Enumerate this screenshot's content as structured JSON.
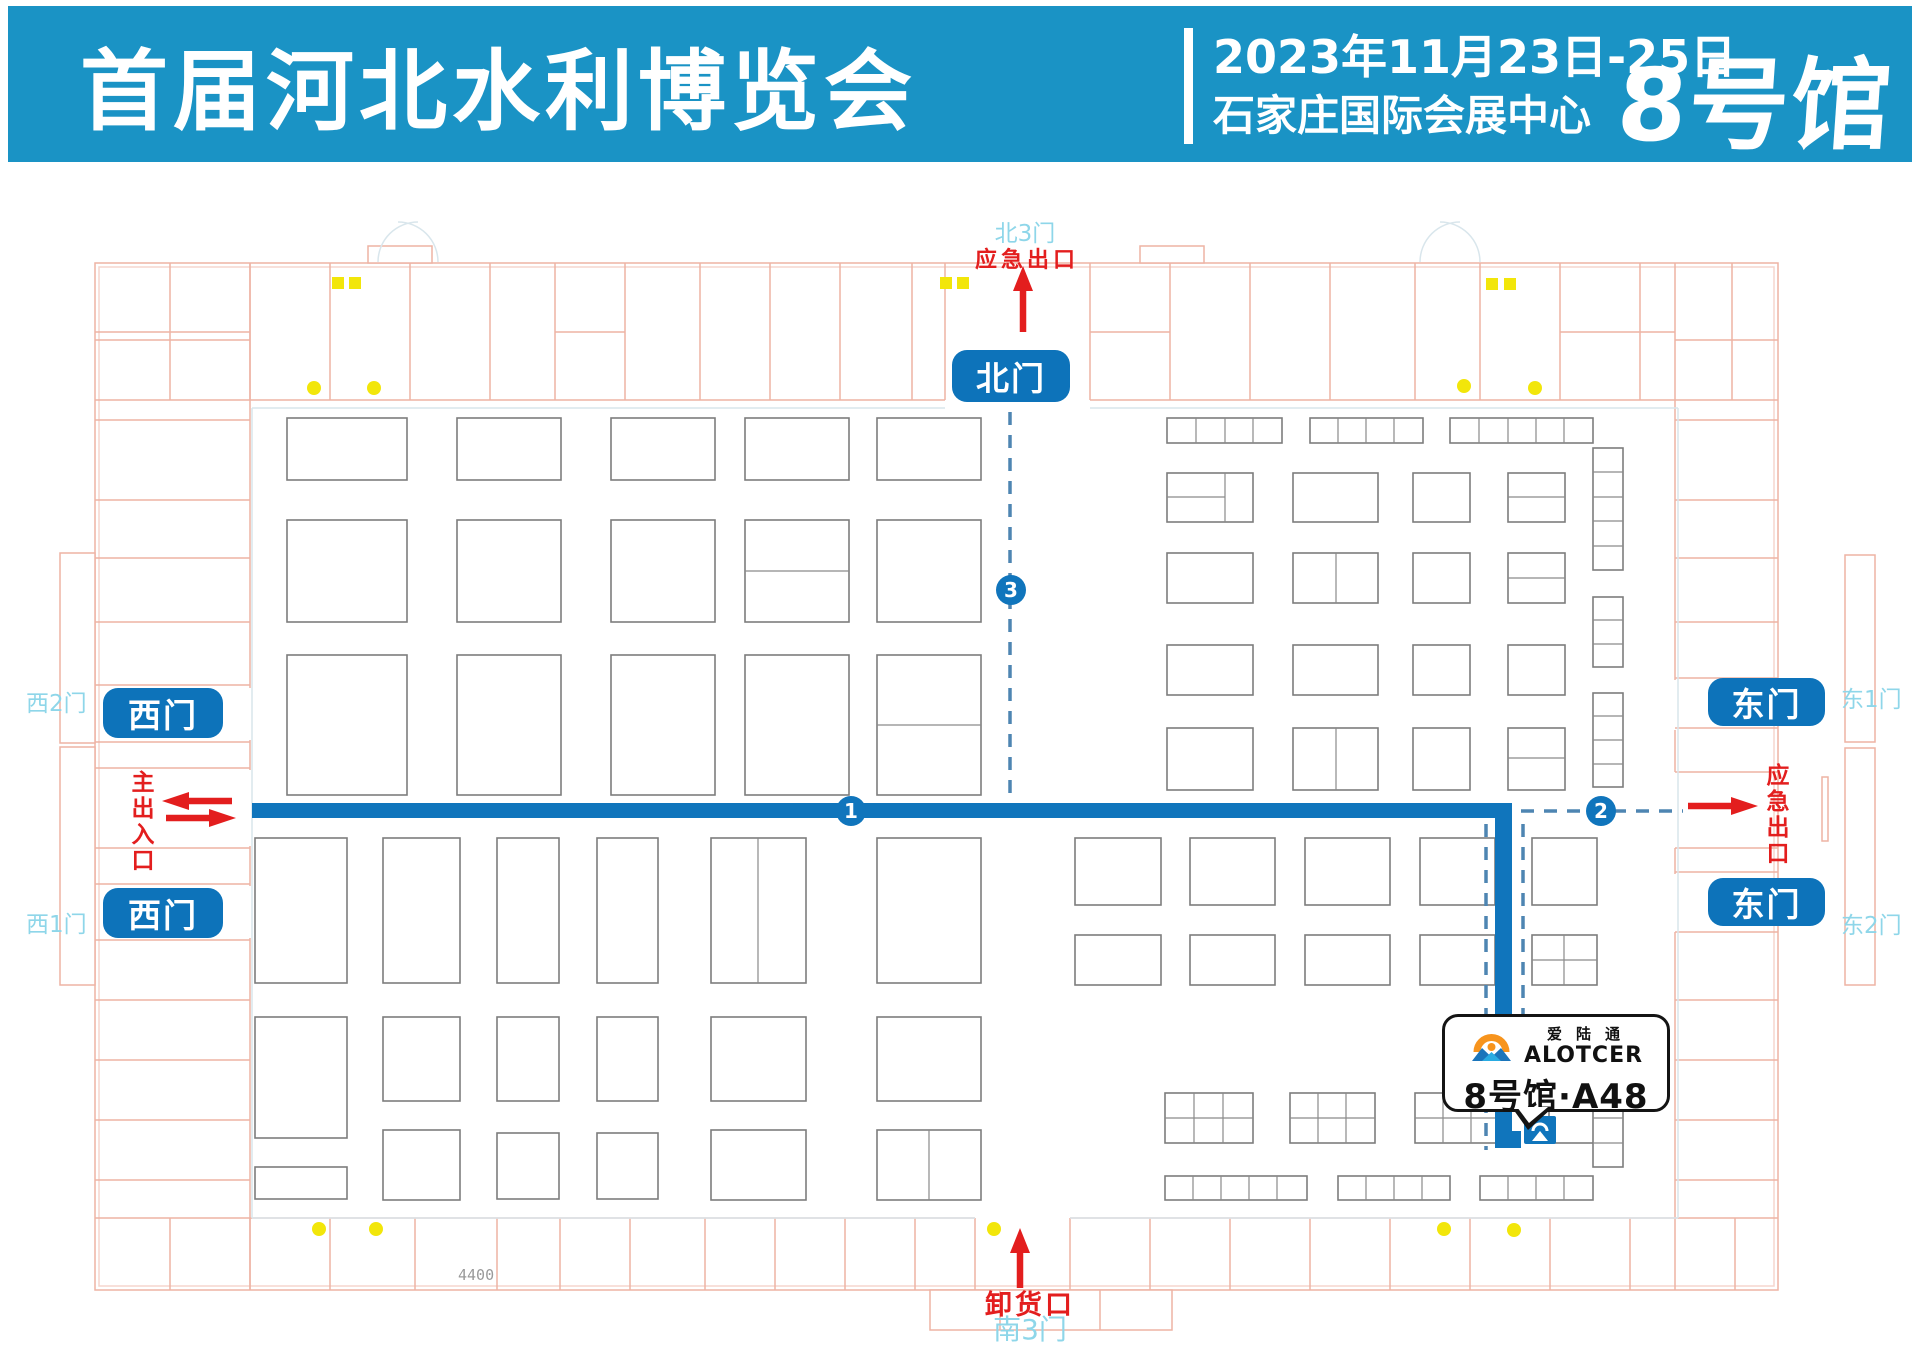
{
  "header": {
    "title": "首届河北水利博览会",
    "date": "2023年11月23日-25日",
    "venue": "石家庄国际会展中心",
    "hall": "8号馆"
  },
  "map": {
    "gates": {
      "north": "北门",
      "west_a": "西门",
      "west_b": "西门",
      "east_a": "东门",
      "east_b": "东门"
    },
    "door_labels": {
      "north_3": "北3门",
      "west_2": "西2门",
      "west_1": "西1门",
      "east_1": "东1门",
      "east_2": "东2门",
      "south_3": "南3门"
    },
    "red_labels": {
      "north_emergency_exit": "应急出口",
      "east_emergency_exit": "应急出口",
      "main_entrance": "主出入口",
      "unloading_dock": "卸货口"
    },
    "route_markers": [
      "1",
      "2",
      "3"
    ],
    "cad_dimension": "4400",
    "booth_callout": {
      "brand_cn": "爱陆通",
      "brand_en": "ALOTCER",
      "booth": "8号馆·A48"
    },
    "colors": {
      "header_blue": "#1a93c5",
      "gate_pill_blue": "#0d73ba",
      "route_blue": "#1075bc",
      "dashed_route_blue": "#4e85b2",
      "alert_red": "#e31e1e",
      "door_label_cyan": "#8ed6e9",
      "cad_line_pink": "#eeb3a4",
      "accent_yellow": "#f2e60a",
      "logo_orange": "#f7941d",
      "logo_blue": "#1b75bb"
    }
  }
}
